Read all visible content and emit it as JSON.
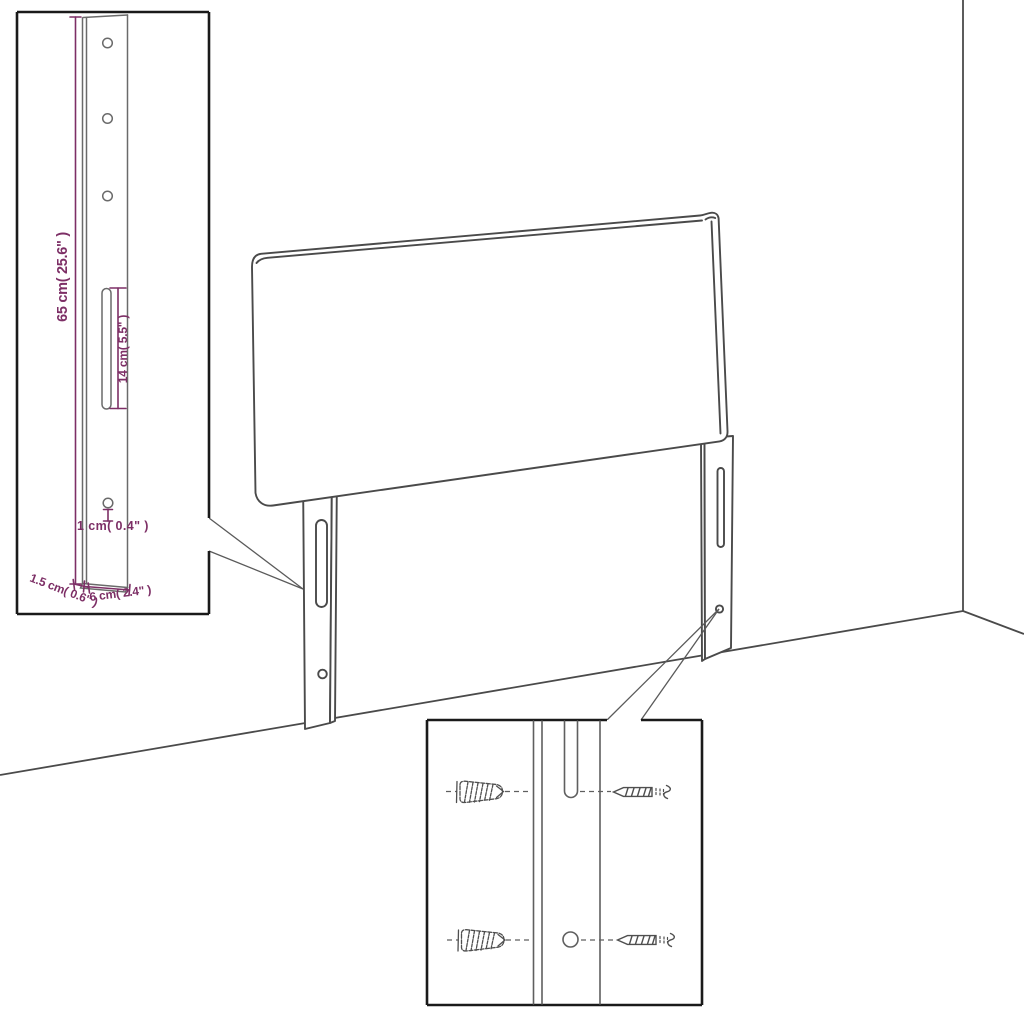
{
  "dimensions": {
    "bracket_height": "65 cm( 25.6\" )",
    "slot_length": "14 cm( 5.5\" )",
    "hole_diameter": "1 cm( 0.4\" )",
    "bracket_thickness": "1.5 cm( 0.6\" )",
    "bracket_width": "6 cm( 2.4\" )"
  },
  "colors": {
    "dimension_text": "#7d2f66",
    "outline": "#4a4a4a",
    "detail_border": "#1a1a1a",
    "background": "#ffffff"
  },
  "icons": {
    "wall_plug": "wall-plug-icon",
    "screw": "screw-icon",
    "mounting_bracket": "mounting-bracket-icon"
  }
}
